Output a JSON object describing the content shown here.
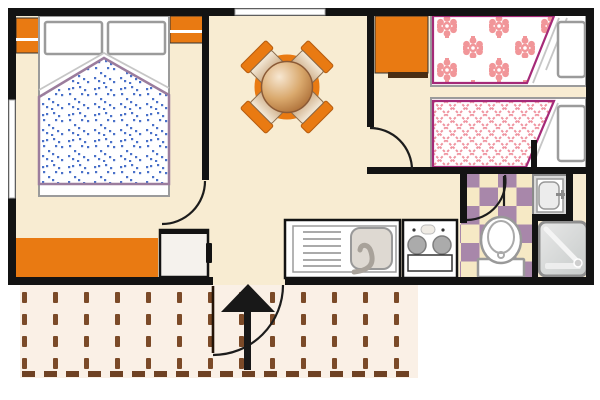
{
  "document": {
    "type": "architectural floor plan",
    "subject": "mobile-home / bungalow layout with terrace",
    "visible_text": "none"
  },
  "colors": {
    "wall": "#131313",
    "floor": "#f8ecd2",
    "orange": "#e97a12",
    "orange-dark": "#4a2e14",
    "gray": "#9b9b9b",
    "blue-dot": "#4a71c9",
    "mauve-border": "#9b7d9d",
    "magenta-border": "#a52a78",
    "pink-flower": "#f19699",
    "pink-lattice": "#ef94a0",
    "tile-purple": "#a887aa",
    "tile-cream": "#f6e9c5",
    "terrace-bg": "#faf0e6",
    "terrace-dash": "#7b4a28",
    "table-wood": "#c98a4b",
    "chair-seat": "#be9365"
  },
  "rooms": [
    {
      "name": "master-bedroom",
      "furniture": [
        "double-bed",
        "two-pillows",
        "blue-dotted-duvet",
        "corner-nightstand",
        "wall-nightstand",
        "orange-bench"
      ]
    },
    {
      "name": "living-dining-room",
      "furniture": [
        "round-table",
        "four-chairs"
      ]
    },
    {
      "name": "kitchen",
      "furniture": [
        "refrigerator",
        "sink-with-drainboard",
        "two-burner-stove",
        "oven"
      ]
    },
    {
      "name": "twin-bedroom",
      "furniture": [
        "orange-wardrobe",
        "single-bed-floral-duvet",
        "single-bed-lattice-duvet",
        "two-pillows"
      ]
    },
    {
      "name": "bathroom",
      "furniture": [
        "toilet",
        "washbasin",
        "shower-tray",
        "checkered-tile-floor"
      ]
    },
    {
      "name": "terrace",
      "furniture": [
        "slatted-decking"
      ]
    }
  ],
  "openings": {
    "windows": [
      "top-wall-window",
      "left-wall-window"
    ],
    "doors": [
      "master-bedroom-door",
      "twin-bedroom-door",
      "bathroom-door",
      "entrance-door"
    ],
    "entrance": {
      "label": "main entrance",
      "direction": "up",
      "marker": "black-arrow"
    }
  }
}
